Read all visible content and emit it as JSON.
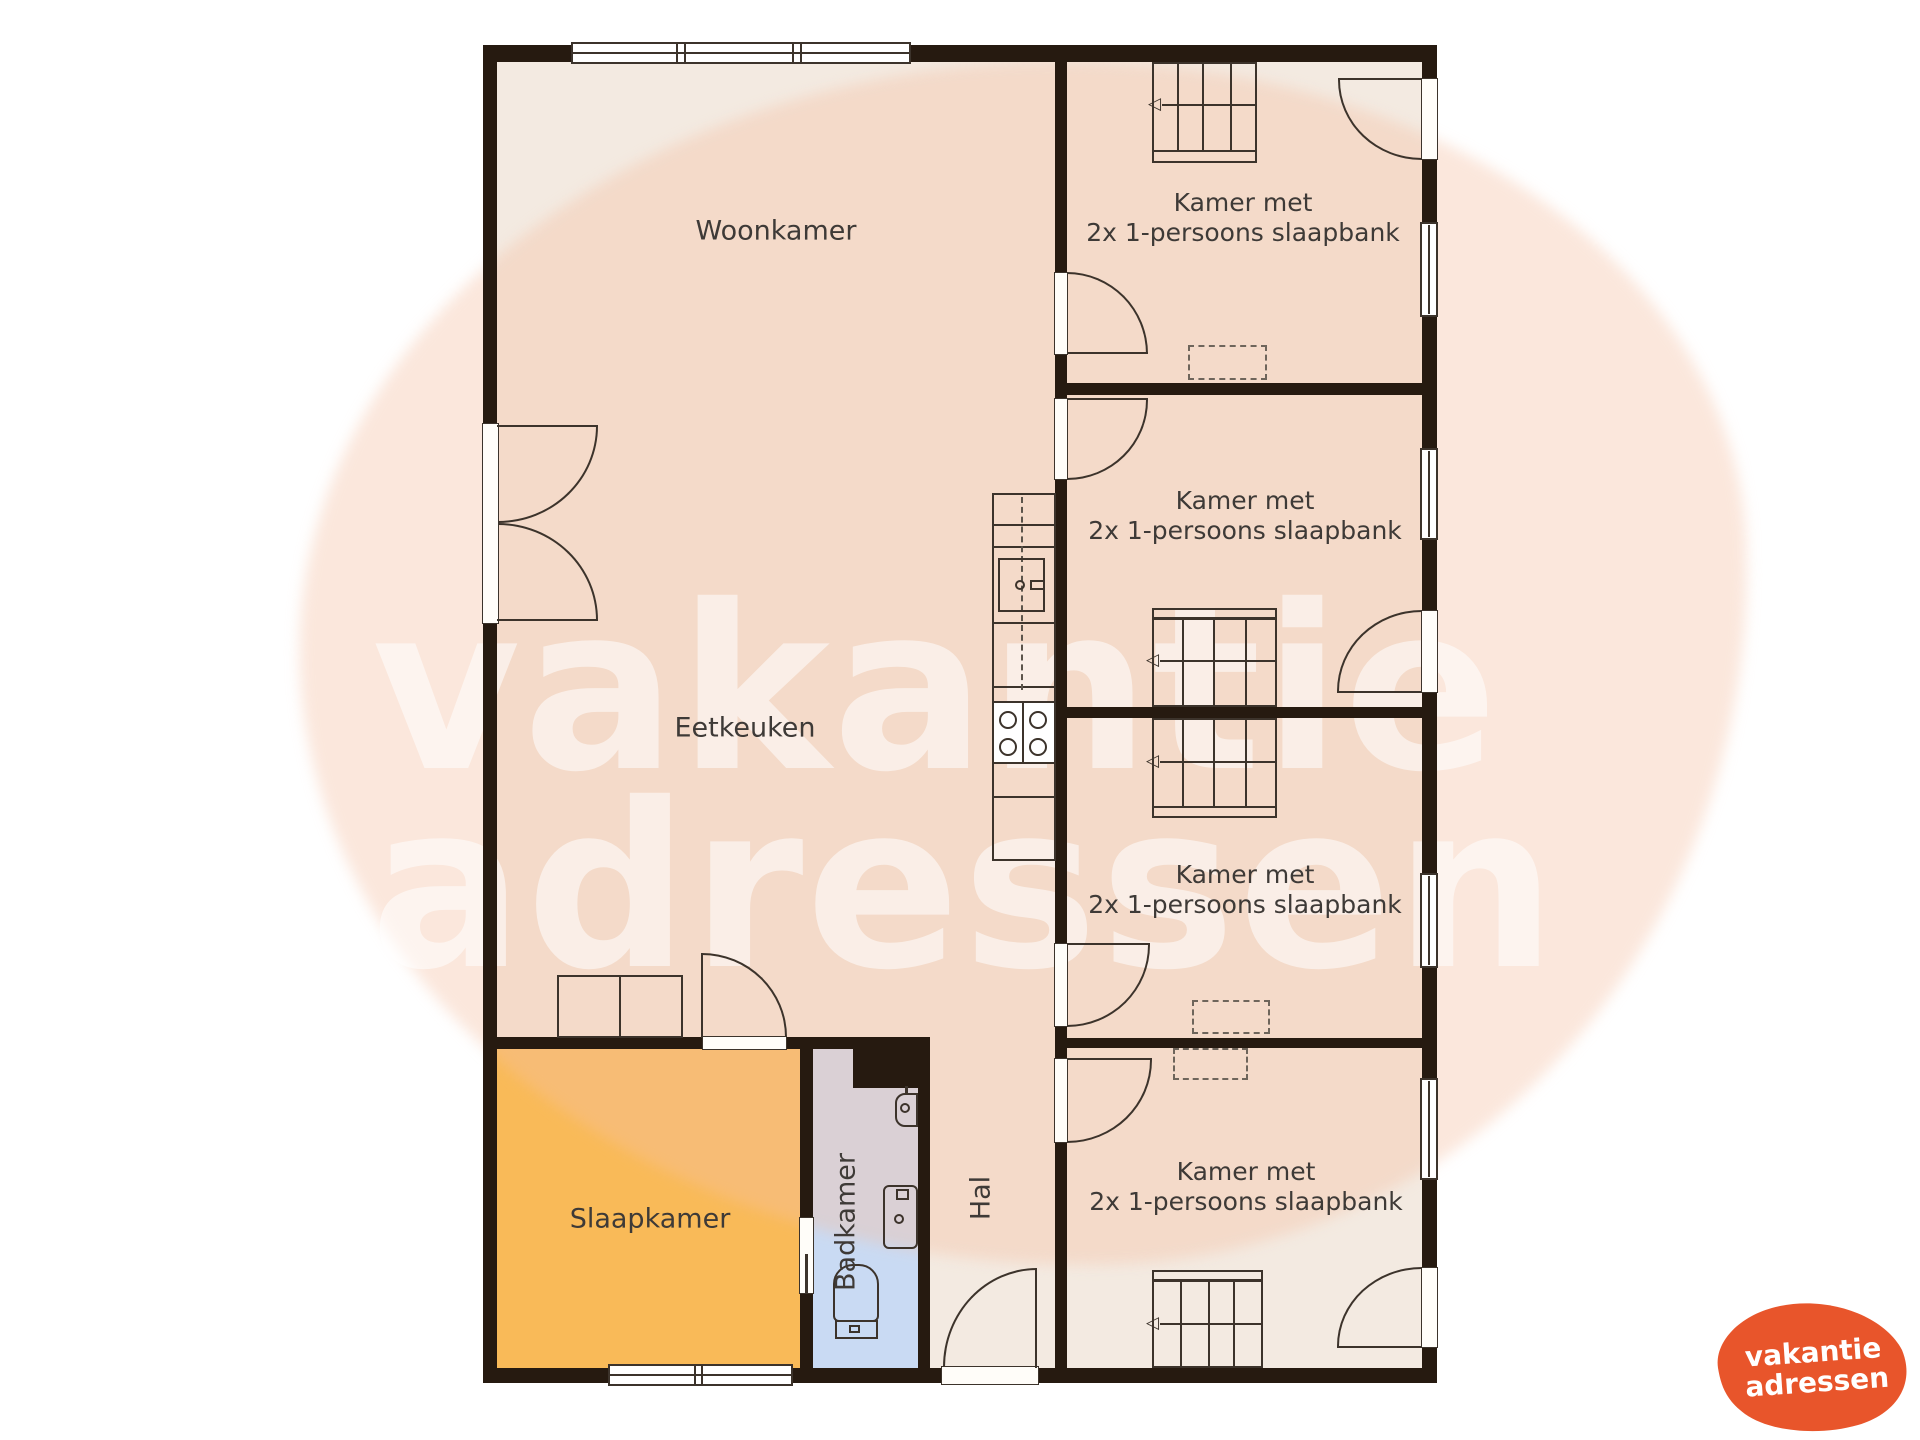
{
  "watermark": {
    "line1": "vakantie",
    "line2": "adressen"
  },
  "logo": {
    "line1": "vakantie",
    "line2": "adressen"
  },
  "labels": {
    "woonkamer": "Woonkamer",
    "eetkeuken": "Eetkeuken",
    "slaapkamer": "Slaapkamer",
    "badkamer": "Badkamer",
    "hal": "Hal"
  },
  "guest_rooms": [
    {
      "line1": "Kamer met",
      "line2": "2x 1-persoons slaapbank"
    },
    {
      "line1": "Kamer met",
      "line2": "2x 1-persoons slaapbank"
    },
    {
      "line1": "Kamer met",
      "line2": "2x 1-persoons slaapbank"
    },
    {
      "line1": "Kamer met",
      "line2": "2x 1-persoons slaapbank"
    }
  ],
  "icons": {
    "stair_arrow": "◁"
  },
  "colors": {
    "wall": "#261a10",
    "line": "#3c332b",
    "floor": "#f3eae1",
    "bedroom": "#f9ba58",
    "bathroom": "#c9daf3",
    "blob": "rgba(244,193,163,0.38)",
    "wmtext": "rgba(255,255,255,0.55)",
    "label": "#3e3a37",
    "logo": "#e8552b",
    "logo_text": "#ffffff"
  }
}
